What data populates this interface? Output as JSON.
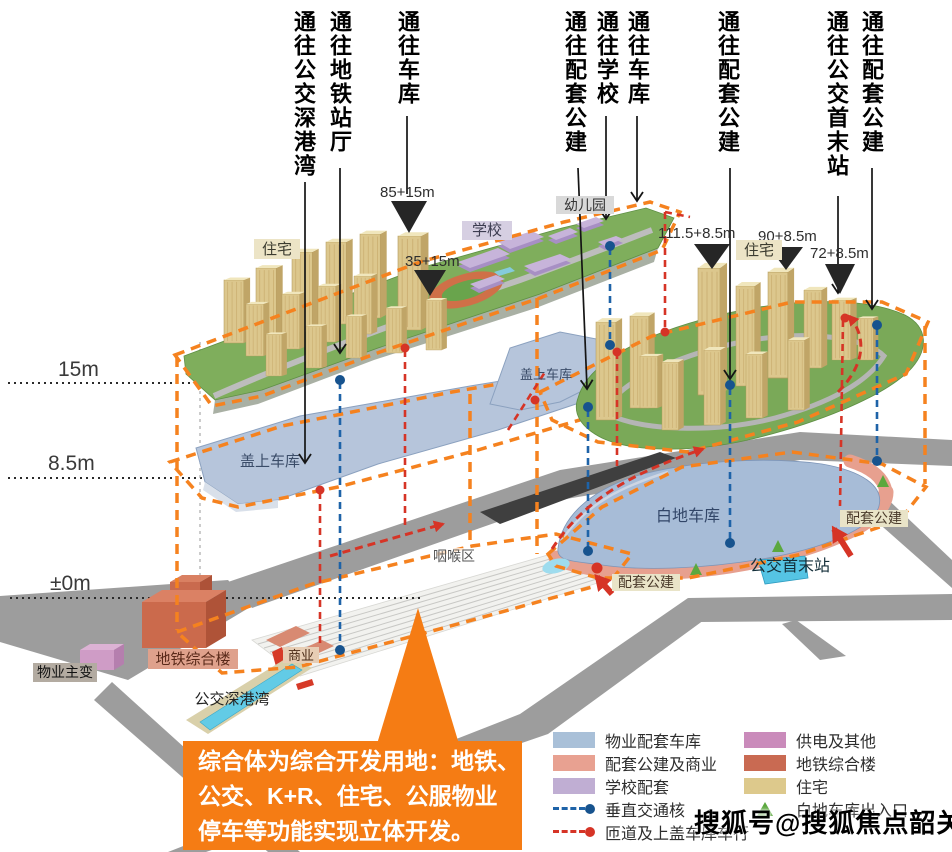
{
  "top_labels": [
    {
      "text": "通往公交深港湾"
    },
    {
      "text": "通往地铁站厅"
    },
    {
      "text": "通往车库"
    },
    {
      "text": "通往配套公建"
    },
    {
      "text": "通往学校"
    },
    {
      "text": "通往车库"
    },
    {
      "text": "通往配套公建"
    },
    {
      "text": "通往公交首末站"
    },
    {
      "text": "通往配套公建"
    }
  ],
  "height_labels": {
    "tower_85": "85+15m",
    "tower_35": "35+15m",
    "tower_111": "111.5+8.5m",
    "tower_90": "90+8.5m",
    "tower_72": "72+8.5m"
  },
  "elevations": {
    "top": "15m",
    "mid": "8.5m",
    "ground": "±0m"
  },
  "map_labels": {
    "residential_left": "住宅",
    "school": "学校",
    "kindergarten": "幼儿园",
    "residential_right": "住宅",
    "podium_garage_left": "盖上车库",
    "podium_garage_right": "盖上车库",
    "white_land_garage": "白地车库",
    "throat_area": "咽喉区",
    "support_public_right": "配套公建",
    "support_public_bottom": "配套公建",
    "bus_terminus": "公交首末站",
    "property_substation": "物业主变",
    "metro_complex": "地铁综合楼",
    "commercial": "商业",
    "bus_bay": "公交深港湾"
  },
  "callout": {
    "lines": [
      "综合体为综合开发用地：地铁、",
      "公交、K+R、住宅、公服物业",
      "停车等功能实现立体开发。"
    ]
  },
  "legend": {
    "col1": [
      {
        "label": "物业配套车库",
        "color": "#a9c0d8",
        "type": "swatch"
      },
      {
        "label": "配套公建及商业",
        "color": "#e8a191",
        "type": "swatch"
      },
      {
        "label": "学校配套",
        "color": "#c0aed3",
        "type": "swatch"
      },
      {
        "label": "垂直交通核",
        "color": "#1e63a8",
        "type": "dashed-line"
      },
      {
        "label": "匝道及上盖车库车行",
        "color": "#d63426",
        "type": "dashed-line"
      }
    ],
    "col2": [
      {
        "label": "供电及其他",
        "color": "#ca8bbb",
        "type": "swatch"
      },
      {
        "label": "地铁综合楼",
        "color": "#c96a52",
        "type": "swatch"
      },
      {
        "label": "住宅",
        "color": "#ddc98c",
        "type": "swatch"
      },
      {
        "label": "白地车库出入口",
        "color": "#5ba83e",
        "type": "triangle"
      }
    ]
  },
  "watermark": "搜狐号@搜狐焦点韶关站",
  "colors": {
    "development_box": "#f5821f",
    "vertical_core": "#1e63a8",
    "ramp_line": "#d63426",
    "callout_bg": "#f57c14",
    "garage_fill": "#a7bcd7",
    "platform_green": "#7fae5c",
    "road_gray": "#9d9d9d"
  }
}
